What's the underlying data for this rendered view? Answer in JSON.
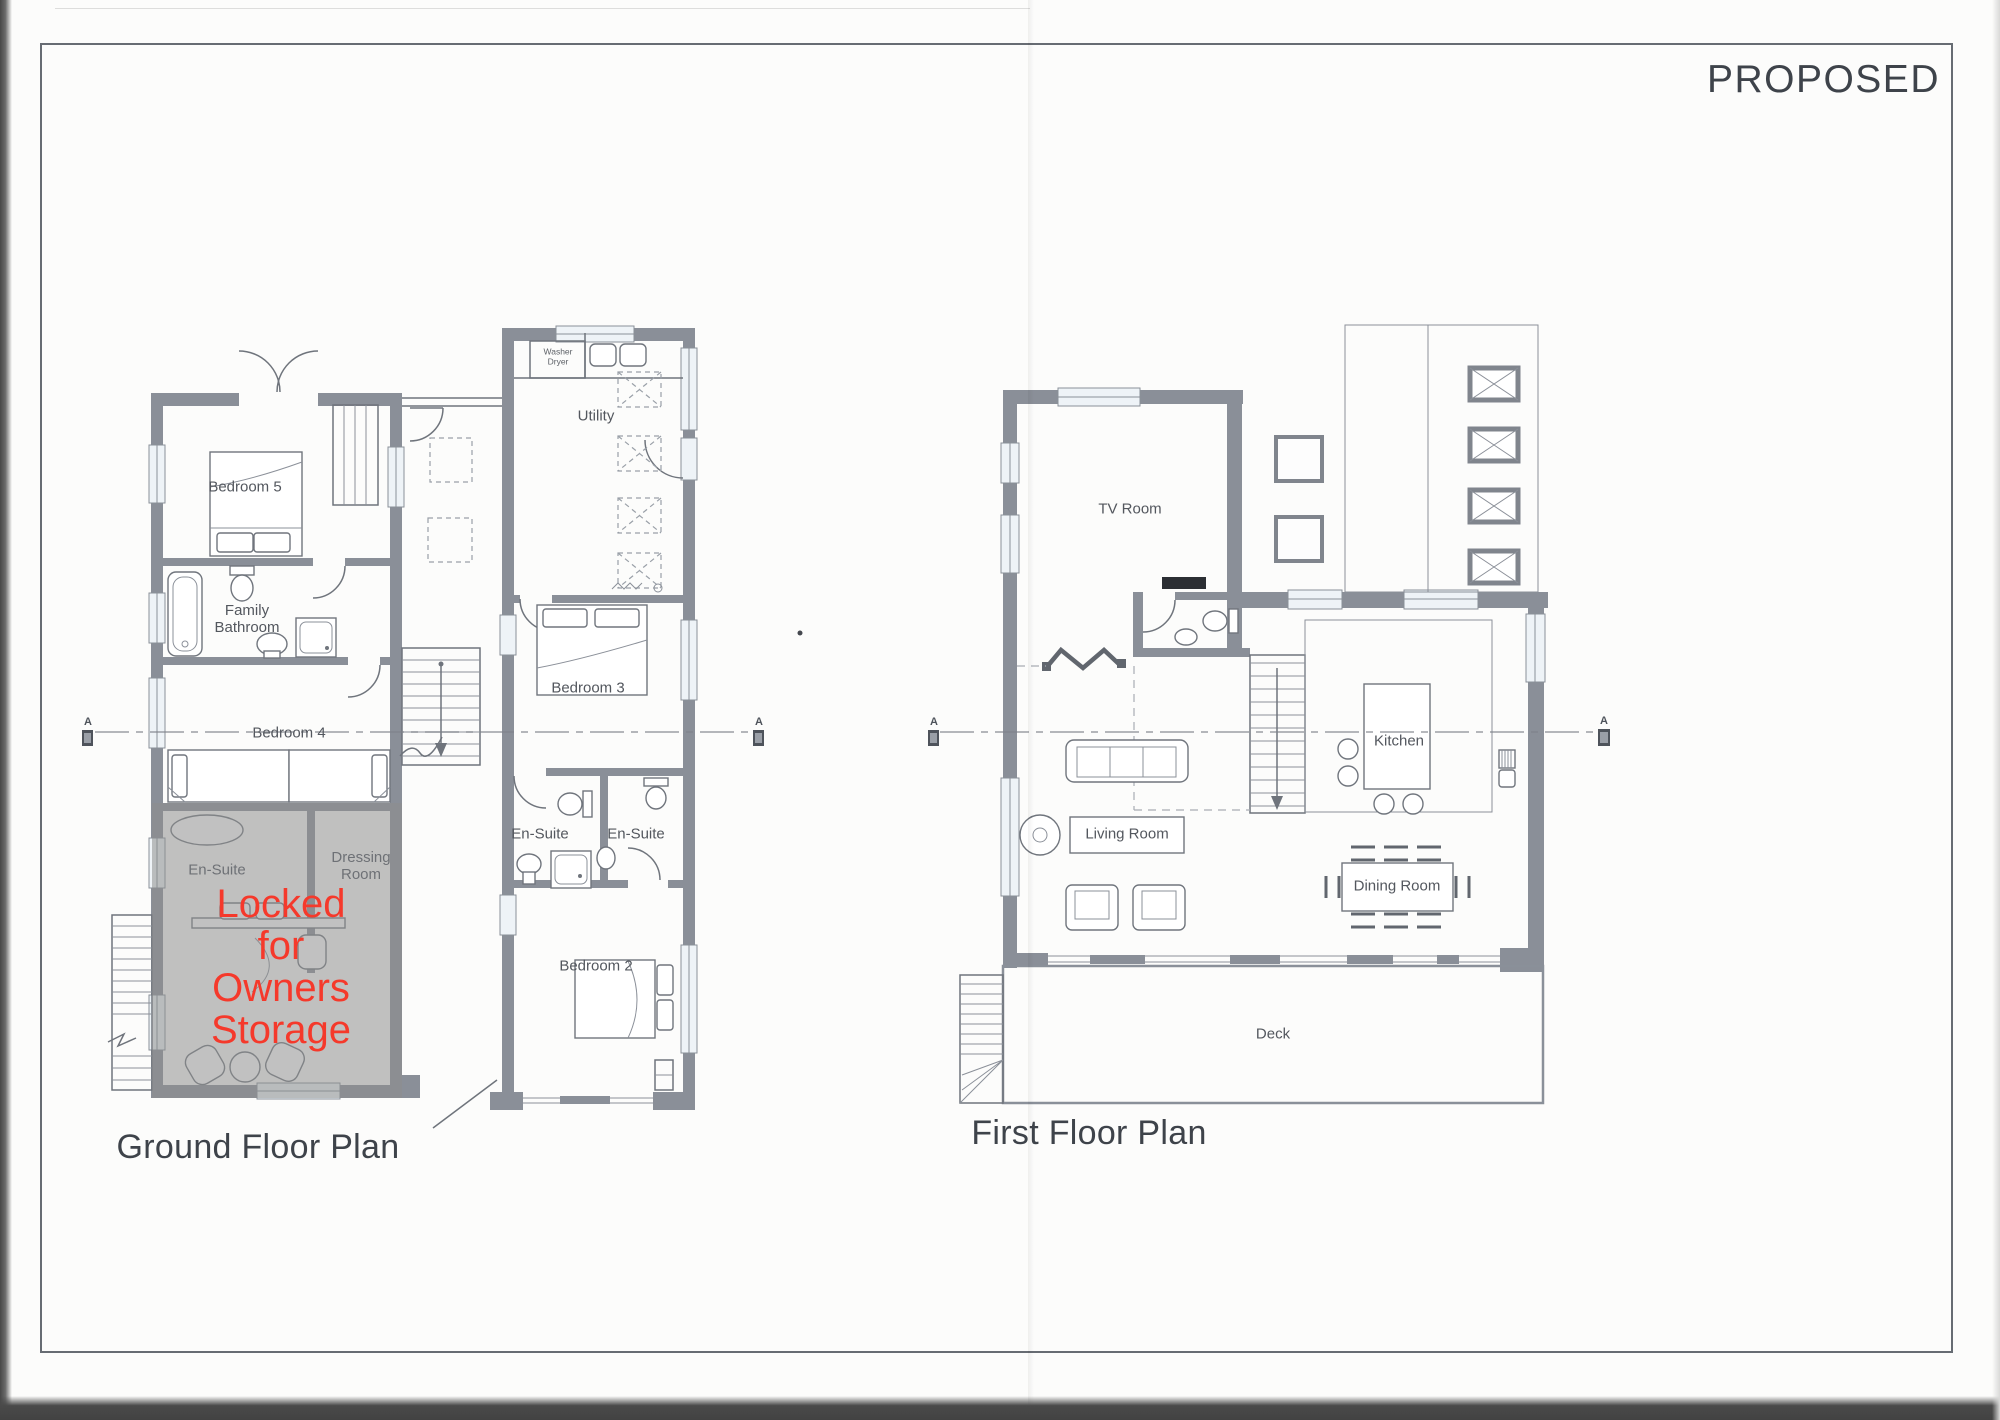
{
  "page": {
    "status_label": "PROPOSED"
  },
  "ground_floor_plan": {
    "caption": "Ground Floor Plan",
    "labels": {
      "bedroom_5": "Bedroom 5",
      "family_bathroom": "Family\nBathroom",
      "bedroom_4": "Bedroom 4",
      "en_suite_locked": "En-Suite",
      "dressing_room": "Dressing\nRoom",
      "locked_note": "Locked\nfor\nOwners\nStorage",
      "utility": "Utility",
      "washer_dryer": "Washer\nDryer",
      "bedroom_3": "Bedroom 3",
      "en_suite_1": "En-Suite",
      "en_suite_2": "En-Suite",
      "bedroom_2": "Bedroom 2"
    }
  },
  "first_floor_plan": {
    "caption": "First Floor Plan",
    "labels": {
      "tv_room": "TV Room",
      "kitchen": "Kitchen",
      "living_room": "Living Room",
      "dining_room": "Dining Room",
      "deck": "Deck"
    }
  },
  "section_marker_label": "A",
  "colors": {
    "wall_gray": "#8a8f98",
    "line_gray": "#6f747c",
    "locked_overlay": "#8e8e8e",
    "locked_text_red": "#f5392b",
    "room_label_text": "#53575e",
    "heading_text": "#3e434a",
    "window_glazing": "#eef3f7"
  }
}
